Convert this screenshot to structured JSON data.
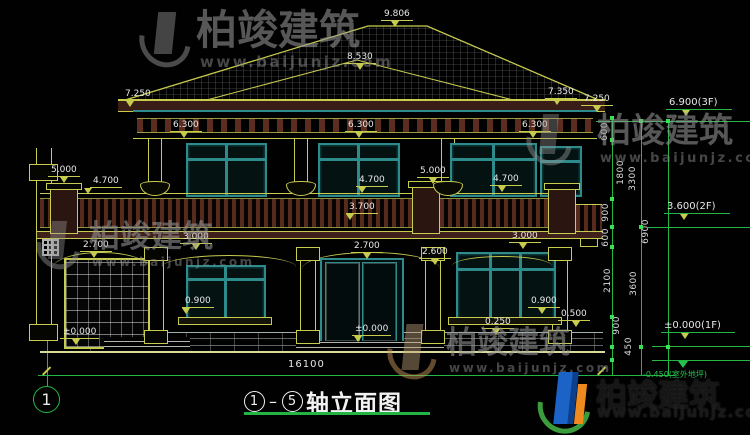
{
  "watermark": {
    "brand": "柏竣建筑",
    "site": "www.baijunjz.com"
  },
  "title": {
    "axis_start": "1",
    "axis_end": "5",
    "text": "轴立面图"
  },
  "axis_bubble": {
    "label": "1"
  },
  "bottom_dim": {
    "total_width": "16100"
  },
  "markers": [
    "9.806",
    "8.530",
    "7.250",
    "7.350",
    "7.250",
    "6.300",
    "6.300",
    "6.300",
    "5.000",
    "4.700",
    "5.000",
    "4.700",
    "4.700",
    "3.700",
    "2.700",
    "3.000",
    "2.700",
    "2.600",
    "3.000",
    "0.900",
    "0.900",
    "0.250",
    "0.500",
    "±0.000",
    "±0.000"
  ],
  "right_levels": [
    "6.900(3F)",
    "3.600(2F)",
    "±0.000(1F)",
    "-0.450(室外地坪)"
  ],
  "vdims": [
    "600",
    "1800",
    "900",
    "600",
    "2100",
    "900",
    "450",
    "3300",
    "3600",
    "6900"
  ],
  "colors": {
    "line_yellow": "#c8cc4e",
    "line_green": "#23b845",
    "window_teal": "#2e8b8b",
    "railing_maroon": "#5b2d20",
    "text_white": "#e8e8e8",
    "logo_blue": "#1c63c8",
    "logo_orange": "#f08a1e",
    "logo_green": "#3a9c3a"
  }
}
